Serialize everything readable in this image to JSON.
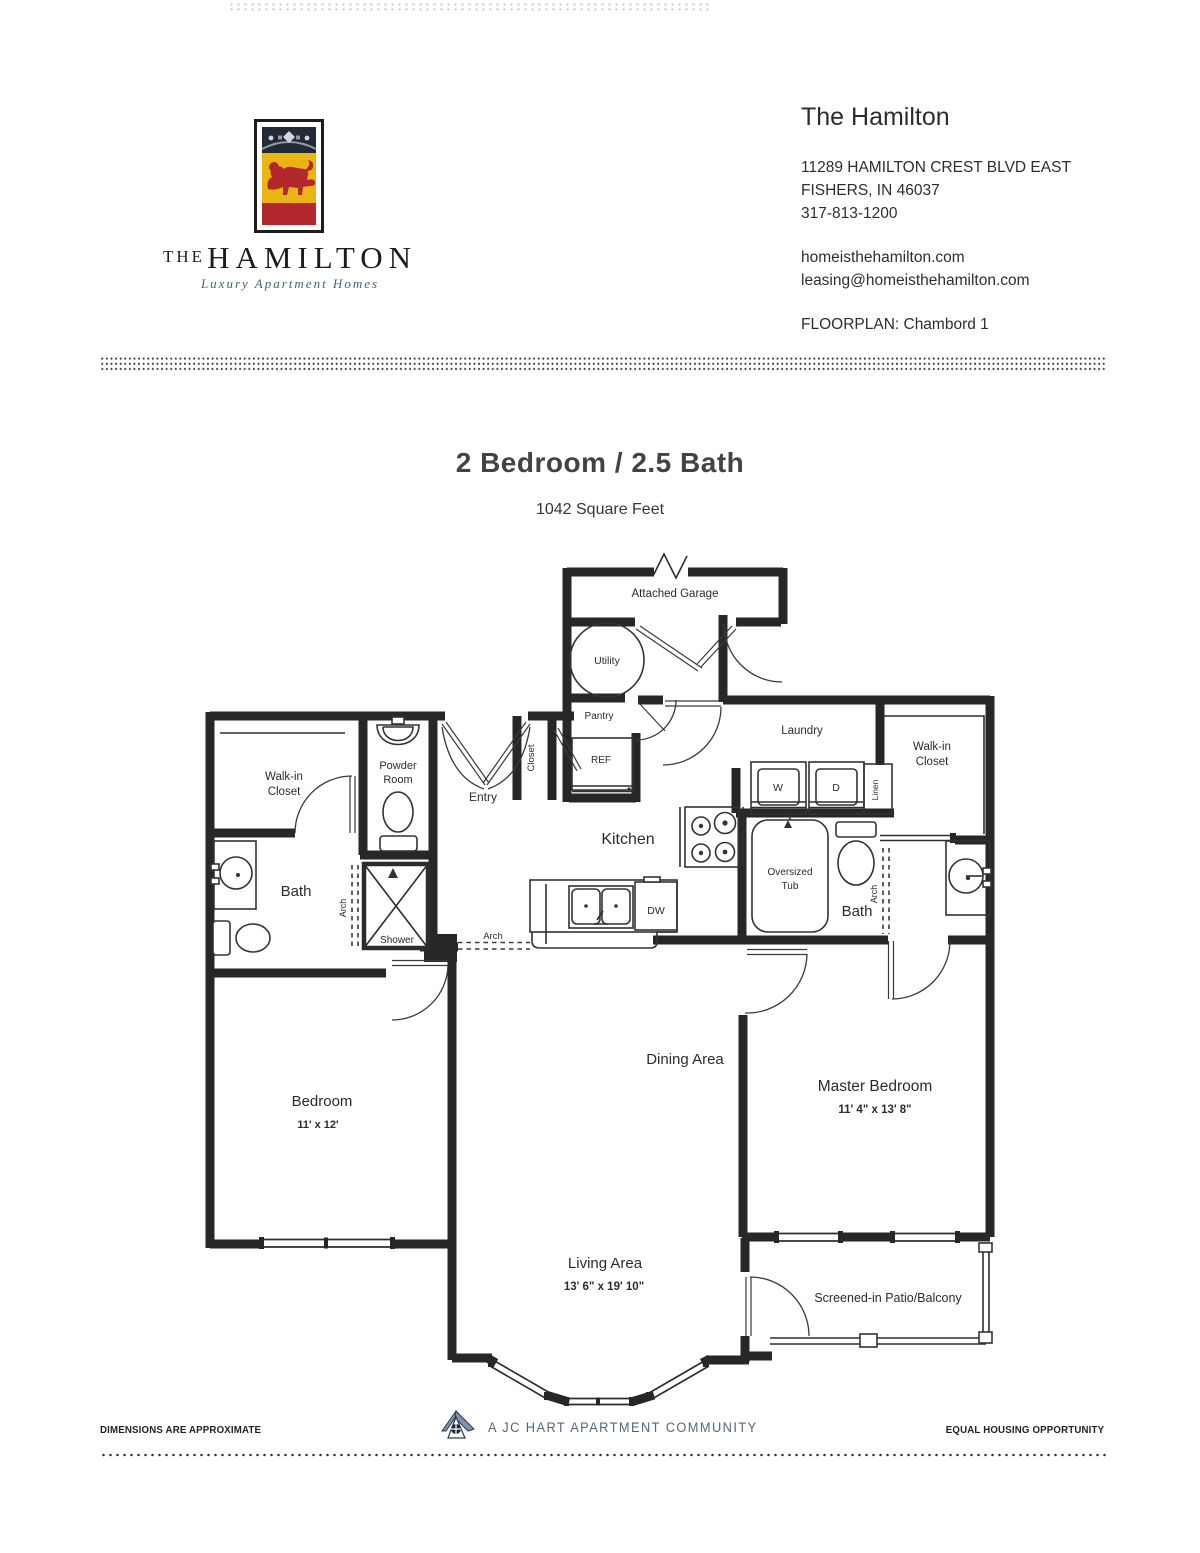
{
  "header": {
    "logo": {
      "brand_top": "THE",
      "brand_name": "HAMILTON",
      "tagline": "Luxury Apartment Homes"
    },
    "property_name": "The Hamilton",
    "address_line1": "11289 HAMILTON CREST BLVD EAST",
    "address_line2": "FISHERS, IN  46037",
    "phone": "317-813-1200",
    "website": "homeisthehamilton.com",
    "email": "leasing@homeisthehamilton.com",
    "floorplan_label": "FLOORPLAN: Chambord 1"
  },
  "title": {
    "heading": "2 Bedroom / 2.5 Bath",
    "subheading": "1042 Square Feet"
  },
  "floorplan": {
    "garage": "Attached Garage",
    "utility": "Utility",
    "pantry": "Pantry",
    "ref": "REF",
    "closet_entry": "Closet",
    "entry": "Entry",
    "powder_room_line1": "Powder",
    "powder_room_line2": "Room",
    "walkin_left_line1": "Walk-in",
    "walkin_left_line2": "Closet",
    "bath_left": "Bath",
    "shower": "Shower",
    "arch_left": "Arch",
    "kitchen": "Kitchen",
    "dishwasher": "DW",
    "arch_kitchen": "Arch",
    "laundry": "Laundry",
    "washer": "W",
    "dryer": "D",
    "linen": "Linen",
    "walkin_right_line1": "Walk-in",
    "walkin_right_line2": "Closet",
    "tub_line1": "Oversized",
    "tub_line2": "Tub",
    "bath_right": "Bath",
    "arch_right": "Arch",
    "dining": "Dining Area",
    "master_bedroom": "Master Bedroom",
    "master_dims": "11' 4\" x 13' 8\"",
    "bedroom": "Bedroom",
    "bedroom_dims": "11' x 12'",
    "living": "Living Area",
    "living_dims": "13' 6\" x 19' 10\"",
    "patio": "Screened-in Patio/Balcony"
  },
  "footer": {
    "left": "DIMENSIONS ARE APPROXIMATE",
    "center": "A JC HART APARTMENT COMMUNITY",
    "right": "EQUAL HOUSING OPPORTUNITY"
  },
  "colors": {
    "crest_gold": "#e9b512",
    "crest_red": "#b3282d",
    "crest_navy": "#222b35",
    "tagline_teal": "#3f6577",
    "footer_blue": "#55677a",
    "ink": "#272727"
  }
}
